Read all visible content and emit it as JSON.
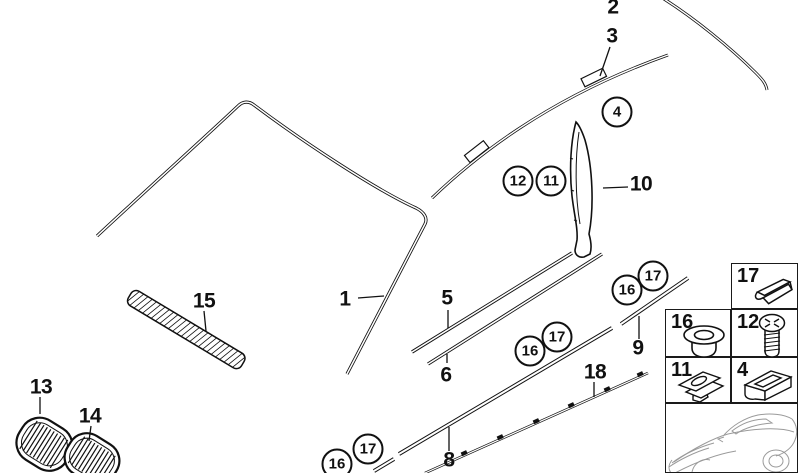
{
  "page": {
    "background_color": "#ffffff",
    "line_color": "#111111",
    "vehicle_sketch_color": "#9a9a9a"
  },
  "callouts": {
    "plain": [
      {
        "text": "2"
      },
      {
        "text": "3"
      },
      {
        "text": "1"
      },
      {
        "text": "5"
      },
      {
        "text": "6"
      },
      {
        "text": "8"
      },
      {
        "text": "9"
      },
      {
        "text": "10"
      },
      {
        "text": "13"
      },
      {
        "text": "14"
      },
      {
        "text": "15"
      },
      {
        "text": "18"
      }
    ],
    "circled": [
      {
        "text": "4"
      },
      {
        "text": "12"
      },
      {
        "text": "11"
      },
      {
        "text": "16"
      },
      {
        "text": "17"
      },
      {
        "text": "16"
      },
      {
        "text": "17"
      },
      {
        "text": "16"
      },
      {
        "text": "17"
      }
    ]
  },
  "legend": {
    "cells": [
      {
        "number": "17",
        "icon": "spring-clip-icon"
      },
      {
        "number": "16",
        "icon": "grommet-icon"
      },
      {
        "number": "12",
        "icon": "screw-icon"
      },
      {
        "number": "11",
        "icon": "expansion-clip-icon"
      },
      {
        "number": "4",
        "icon": "bracket-clip-icon"
      }
    ],
    "vehicle_thumbnail": "coupe-silhouette"
  }
}
